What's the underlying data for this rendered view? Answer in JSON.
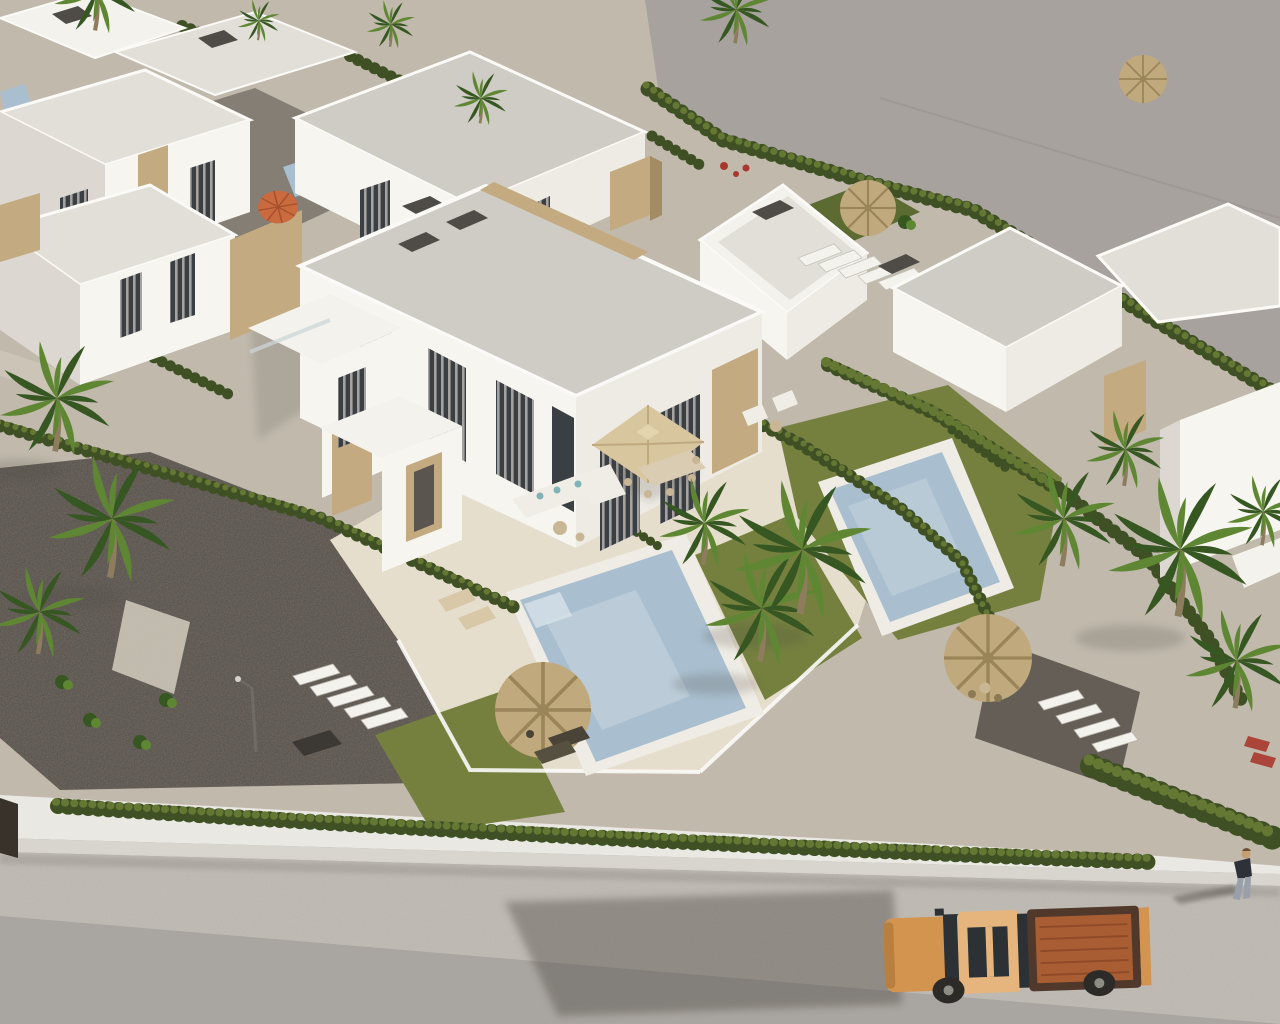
{
  "meta": {
    "type": "3d-architectural-render",
    "view": "aerial drone view",
    "description": "Photorealistic 3D render of a residential development of modern white flat-roof villas with travertine stone accents, private pools, lawns, palm trees and cypress hedges; an empty graded plot lies beyond the boundary fence at the top right; a street runs along the bottom with an orange double-cab pickup truck and a pedestrian walking past."
  },
  "palette": {
    "vacant": "#a7a29e",
    "vacantSeam": "#9a9591",
    "ground": "#c0b9ac",
    "gravel": "#544e47",
    "terrace": "#e6decd",
    "lawn": "#75803f",
    "lawnShade": "#5c6b32",
    "hedge": "#3f5124",
    "hedgeLit": "#647733",
    "pool": "#a9bfcf",
    "poolLight": "#cdd9e1",
    "poolRim": "#efece5",
    "villa": "#f7f5f0",
    "villaSide": "#edebe4",
    "villaShade": "#dcd8d1",
    "roof": "#cfccc6",
    "roofLight": "#e2dfd9",
    "parapet": "#f4f2ec",
    "stone": "#c3aa80",
    "stoneShade": "#a38b63",
    "chimney": "#4f4c48",
    "glass": "#3a3f44",
    "curtain": "#b7b4af",
    "road": "#bab6af",
    "roadLower": "#a9a5a0",
    "sidewalk": "#eae8e2",
    "wallFace": "#d8d5ce",
    "shadow": "#4e4a43",
    "fence": "#39322b",
    "palm": "#5f8733",
    "palmDark": "#375722",
    "trunk": "#8d7c5e",
    "canopy": "#d8c69f",
    "canopyShade": "#bfa97f",
    "straw": "#c0a97c",
    "strawLine": "#9a845a",
    "sofa": "#f0ede6",
    "teal": "#7fb3b5",
    "wicker": "#c9b694",
    "tan": "#d8c8a8",
    "truck": "#d3944f",
    "truckRoof": "#e6b57d",
    "truckBed": "#a85d33",
    "truckRim": "#50392b",
    "dark2": "#2c3136",
    "tire": "#2d2b28",
    "hub": "#8f8c86",
    "skin": "#c79d72",
    "jacket": "#2e3138",
    "jeans": "#99a0ac",
    "orange": "#c96a3f",
    "flower": "#a8382e",
    "lamp": "#6f6c66"
  },
  "scene": {
    "vacant_land": "empty gray graded plot beyond boundary fence (top right)",
    "villas": "rows of white flat-roof villas with stone accent panels, gray gravel roofs, dark chimney caps and curtained floor-to-ceiling windows",
    "hero_villa": "central two-storey semi-detached villa with beige shade sail over dining set, white corner sofa with teal cushions, private pool and lawn",
    "pools": [
      "central private pool",
      "right-garden private pool",
      "two small pools glimpsed top left"
    ],
    "street": "light asphalt road along the bottom with white boundary wall and continuous hedge",
    "vehicle": {
      "kind": "double-cab pickup truck with open bed",
      "color_name": "orange/copper"
    },
    "pedestrian": {
      "kind": "person walking on the road edge",
      "clothing": "dark jacket, light jeans"
    },
    "vegetation": [
      "fan palms",
      "banana plants",
      "cypress hedges",
      "lawn strips",
      "shrubs"
    ],
    "props": [
      "straw thatch parasols",
      "orange parasol",
      "sun loungers",
      "outdoor dining set",
      "street lamp",
      "garden stairs",
      "red flowering bush"
    ]
  }
}
